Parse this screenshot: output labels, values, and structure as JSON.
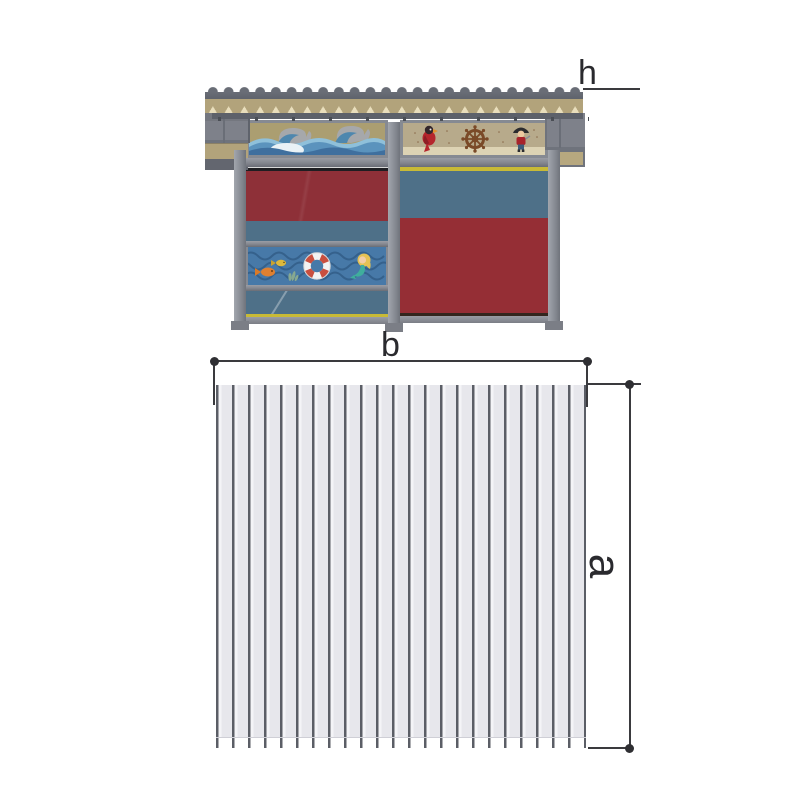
{
  "dimensions": {
    "h": "h",
    "b": "b",
    "a": "a"
  },
  "palette": {
    "frame_gray": "#83868e",
    "roof_gray": "#696d76",
    "fascia_tan": "#b2a37b",
    "panel_red": "#8e3038",
    "panel_blue_gray": "#4e7088",
    "accent_yellow": "#c8ba36",
    "sea_blue": "#4779a8",
    "lifebuoy_red": "#c94f3f",
    "plan_panel_gray": "#e7e7ec",
    "plan_rib_gray": "#5b5e66",
    "dimension_line": "#3a3a3e"
  },
  "icons": {
    "left_top_panel": "ocean-waves-art",
    "right_top_panel": [
      "parrot-icon",
      "ship-wheel-icon",
      "pirate-icon"
    ],
    "left_middle_panel": [
      "fish-icon",
      "fish-icon",
      "coral-icon",
      "lifebuoy-icon",
      "mermaid-icon"
    ]
  }
}
